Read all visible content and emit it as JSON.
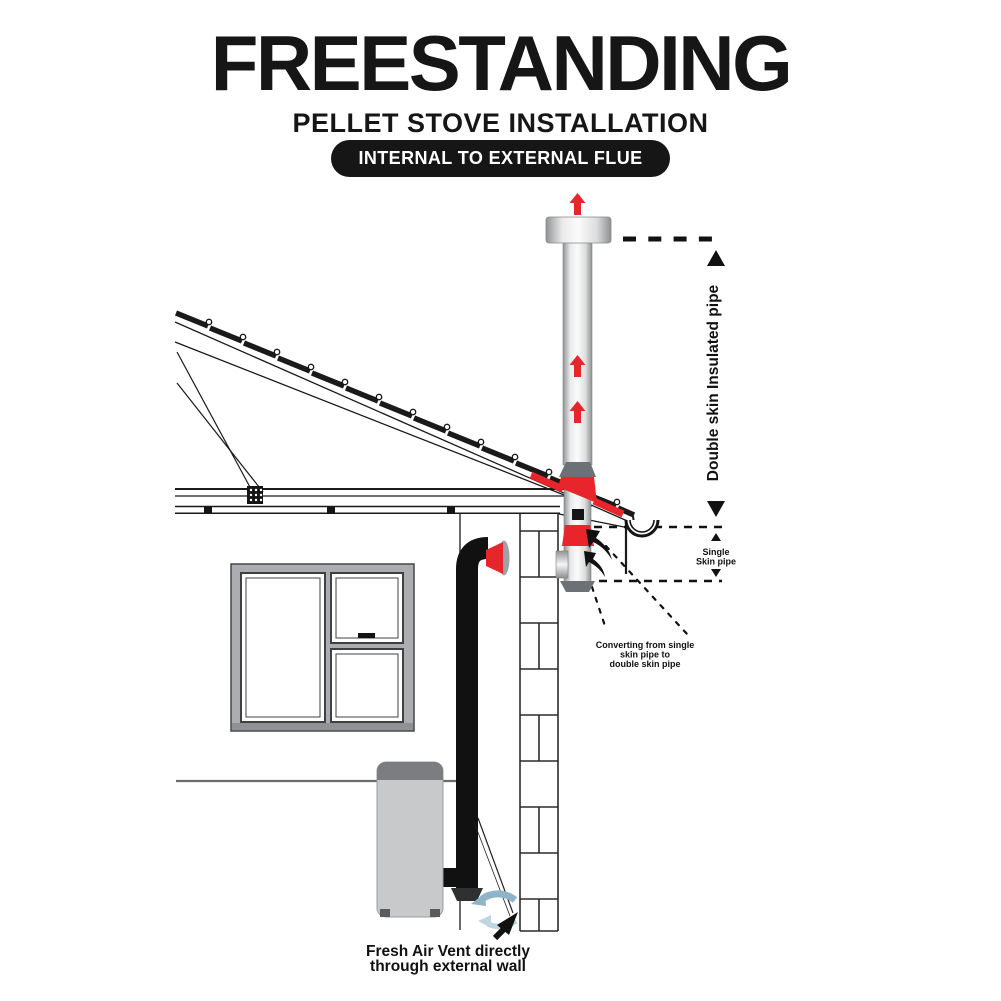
{
  "header": {
    "title": "FREESTANDING",
    "subtitle": "PELLET STOVE INSTALLATION",
    "badge": "INTERNAL TO EXTERNAL FLUE"
  },
  "labels": {
    "double_skin": "Double skin Insulated pipe",
    "single_skin_line1": "Single",
    "single_skin_line2": "Skin pipe",
    "converting_line1": "Converting from single",
    "converting_line2": "skin pipe to",
    "converting_line3": "double skin pipe",
    "fresh_air_line1": "Fresh Air Vent directly",
    "fresh_air_line2": "through external wall"
  },
  "icons": {
    "red_flow_arrow": "upward flue-gas flow arrow",
    "dimension_triangle": "dimension end triangle",
    "fresh_air_arrow": "curved fresh-air inflow arrow",
    "pointer_arrow": "black pointer arrow"
  },
  "colors": {
    "accent_red": "#e8252a",
    "ink": "#161616",
    "steel_gray": "#6c7175",
    "stove_gray": "#c7c9cb",
    "air_blue": "#8fb4c9",
    "air_blue_light": "#bfd6e2"
  }
}
